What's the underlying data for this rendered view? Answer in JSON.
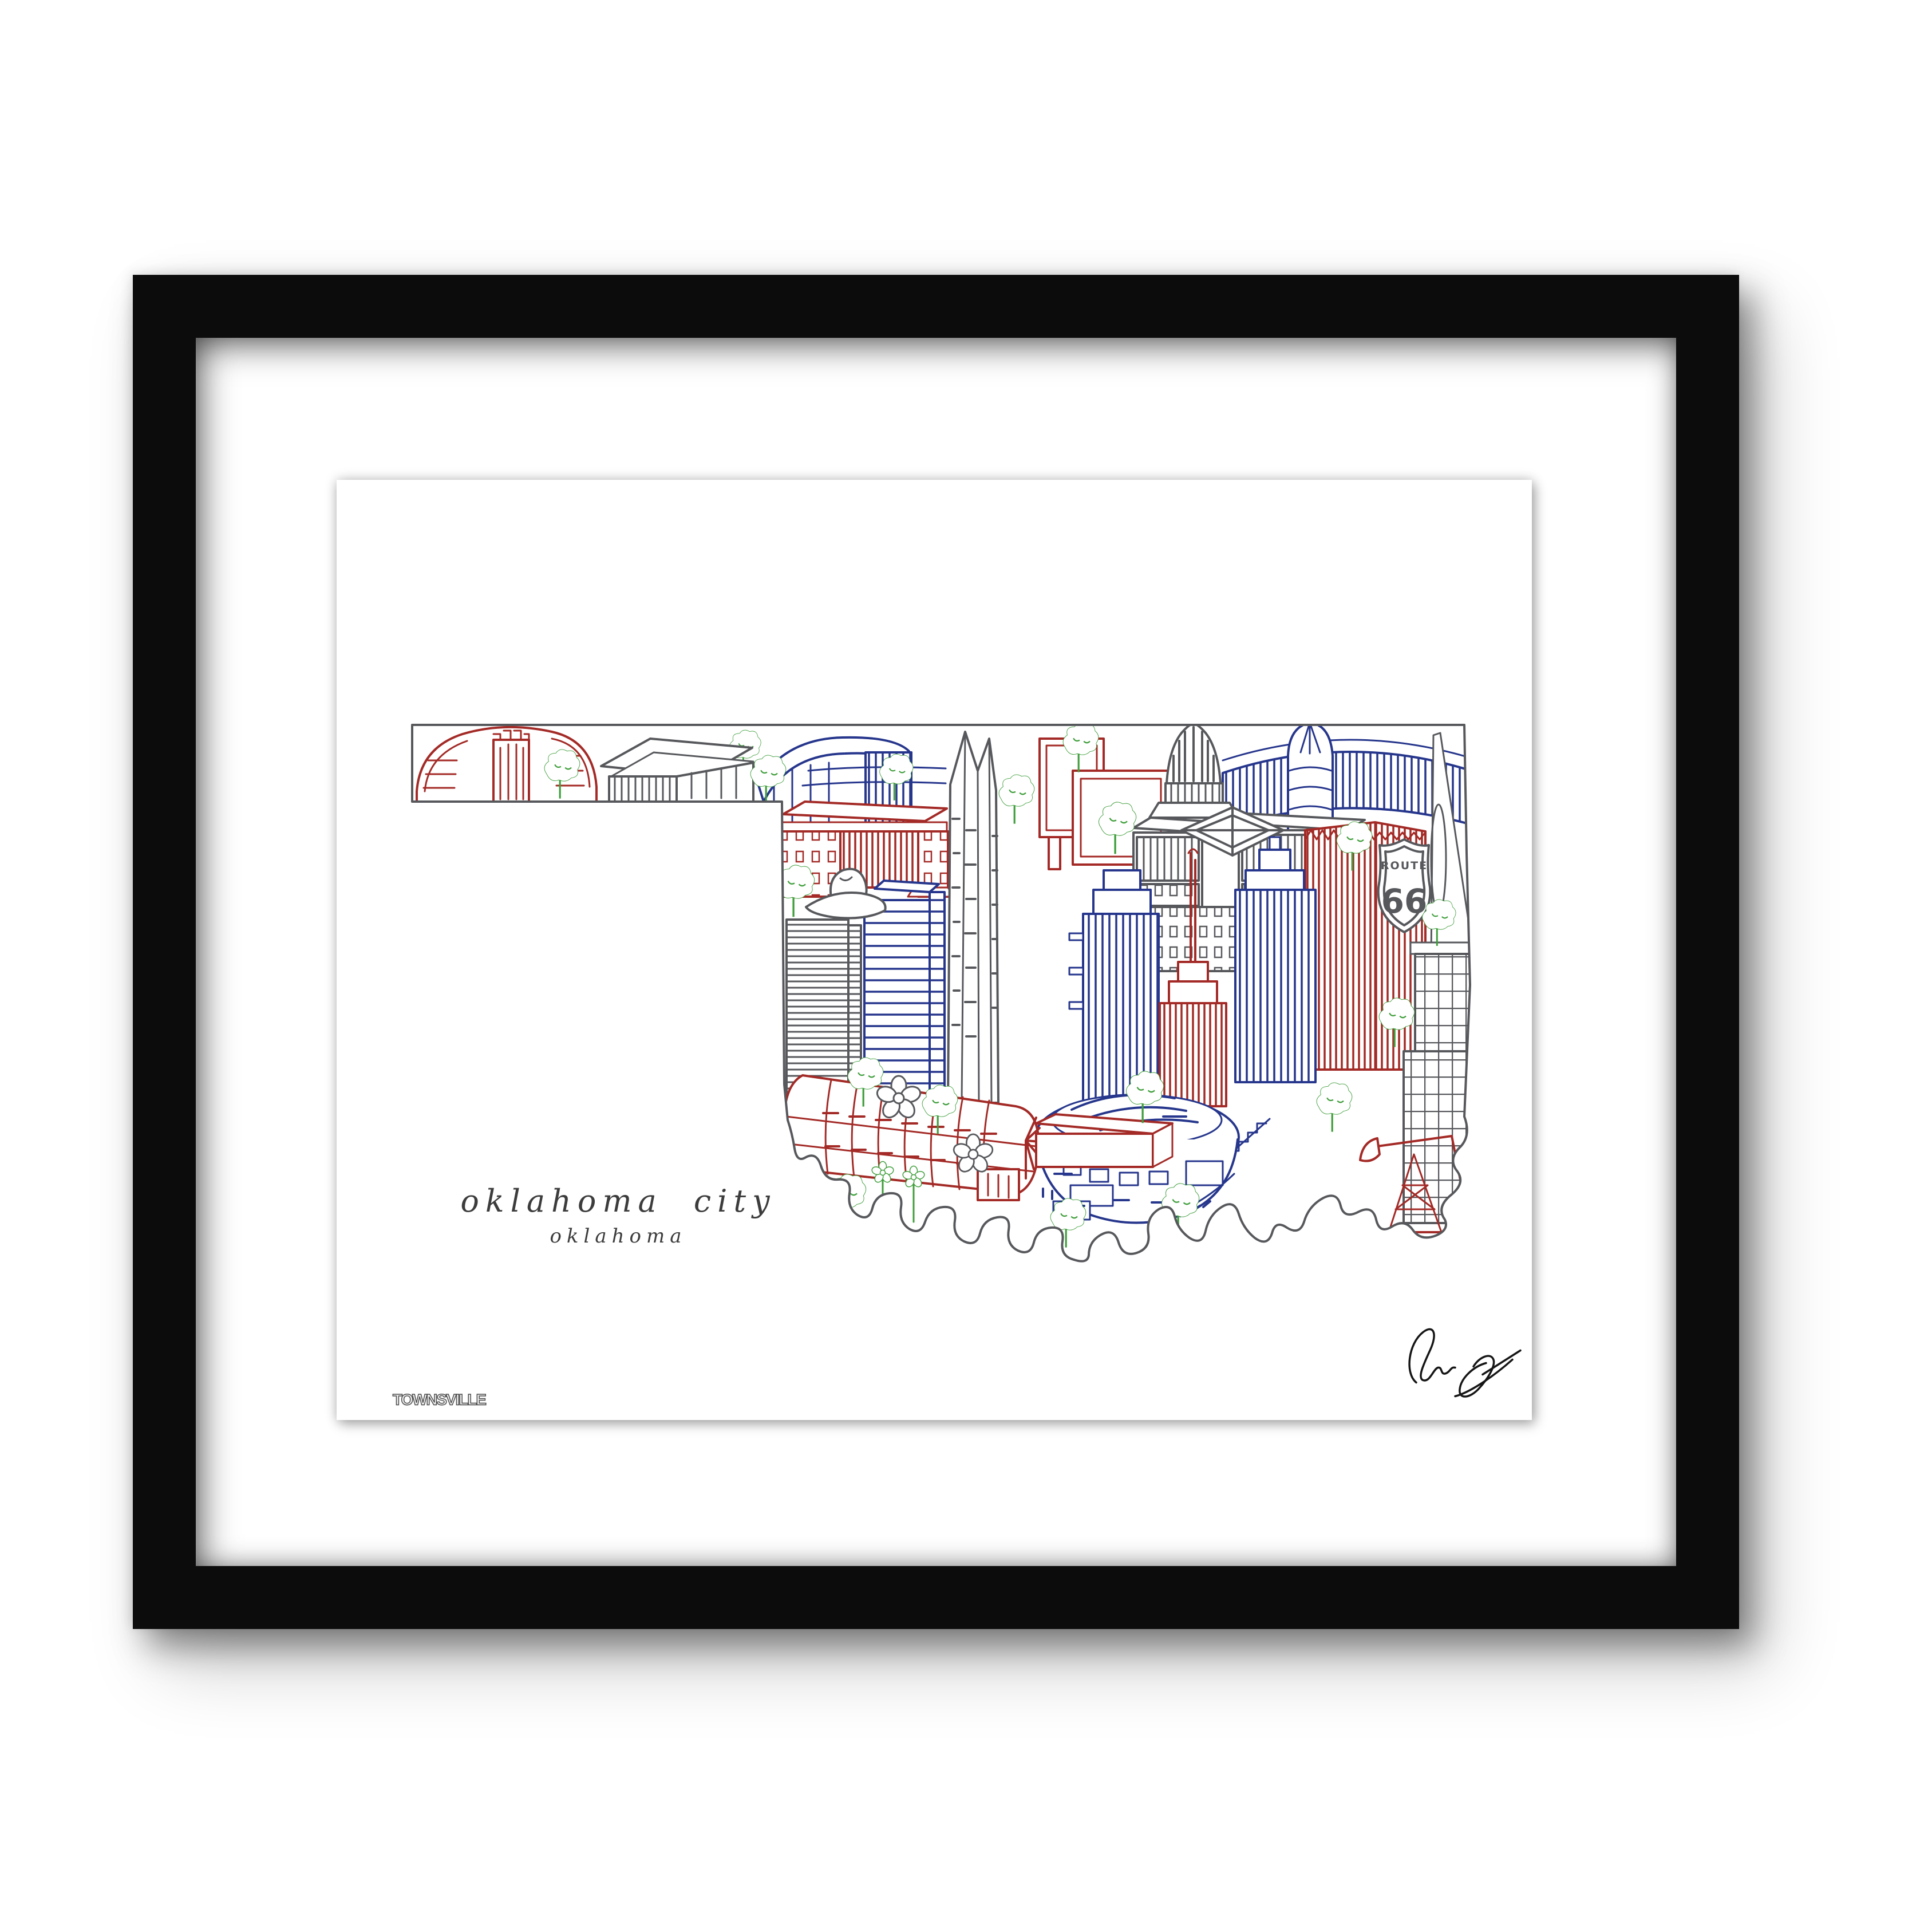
{
  "frame": {
    "frame_color": "#0c0c0c",
    "mat_color": "#ffffff"
  },
  "print": {
    "title": "oklahoma city",
    "subtitle": "oklahoma",
    "publisher_logo": "TOWNSVILLE",
    "route_sign": {
      "word": "ROUTE",
      "number": "66"
    },
    "palette": {
      "red": "#A32A26",
      "blue": "#26368C",
      "gray": "#57585C",
      "green": "#3F9E3B",
      "title_text": "#3C3C3C",
      "signature_ink": "#151515"
    }
  }
}
